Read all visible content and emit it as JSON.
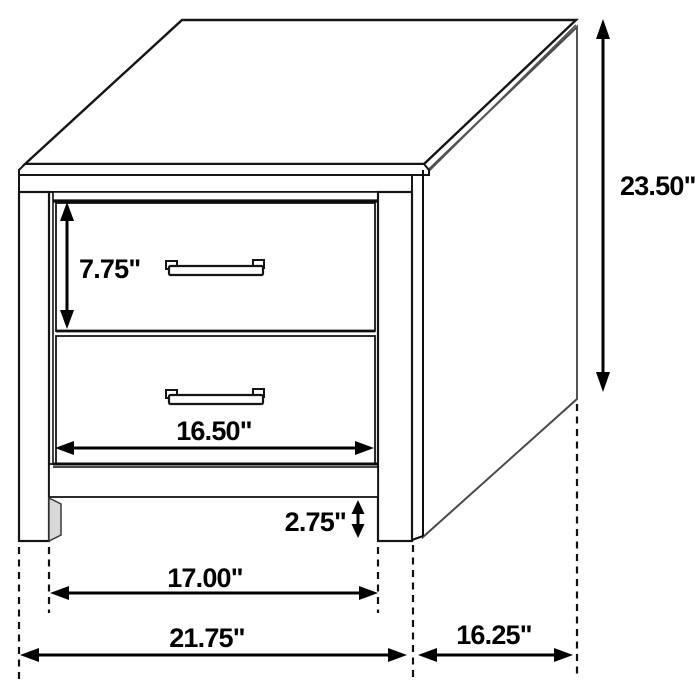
{
  "diagram": {
    "background_color": "#ffffff",
    "line_color": "#151515",
    "dimension_labels": {
      "overall_height": "23.50\"",
      "overall_width": "21.75\"",
      "depth": "16.25\"",
      "top_drawer_height": "7.75\"",
      "drawer_width": "16.50\"",
      "bottom_clearance": "2.75\"",
      "leg_span": "17.00\""
    }
  }
}
